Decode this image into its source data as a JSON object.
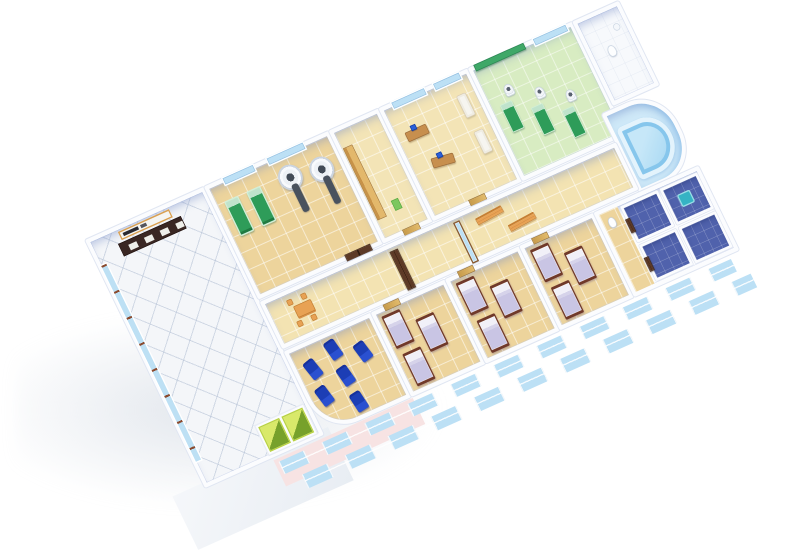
{
  "scene": {
    "description": "3D isometric cutaway floor plan of a hospital ward floor on a white background",
    "background_color": "#ffffff",
    "view": "axonometric cutaway, building rotated diagonally"
  },
  "palette": {
    "floor_tile_tan": "#EDD49C",
    "floor_lobby_white": "#F4F6F9",
    "floor_physio_green": "#D8ECC2",
    "floor_bath_blue": "#5062AC",
    "wall_white": "#FBFCFE",
    "wall_inner_tint": "#C8D5F0",
    "window_blue": "#BCE0F5",
    "facade_pink": "#F7E3E3",
    "bed_frame_brown": "#70392A",
    "bedding_lavender": "#C9C5E4",
    "exam_table_green": "#2E9C59",
    "recliner_blue": "#1C3EB5",
    "furniture_orange": "#E8A254",
    "door_dark_brown": "#5D3A26",
    "door_light_wood": "#D2A756",
    "elevator_green": "#B9D243",
    "pool_blue": "#AEDCF5"
  },
  "rooms": {
    "lobby": {
      "label": "Lobby and reception hall",
      "items": [
        "reception desk",
        "sign board with dark illegible lettering",
        "brown-framed window wall",
        "2 green elevators",
        "diamond tiled floor"
      ]
    },
    "radiology": {
      "label": "Radiology / scanner room",
      "items": [
        "2 green exam beds",
        "2 CT scanners with patient tables",
        "dark brown double door"
      ]
    },
    "storage": {
      "label": "Storage room",
      "items": [
        "wooden cabinet",
        "green mat"
      ]
    },
    "office": {
      "label": "Doctors office",
      "items": [
        "2 desks with blue computer monitors",
        "2 white couches"
      ]
    },
    "physio": {
      "label": "Physiotherapy room",
      "items": [
        "3 green treatment tables",
        "3 C-arm machines",
        "green wall panels"
      ]
    },
    "toilet": {
      "label": "Toilet room",
      "items": [
        "toilet",
        "sink"
      ]
    },
    "hydro": {
      "label": "Hydrotherapy corner with curved pool",
      "items": [
        "curved blue pool",
        "rounded glass corner wall"
      ]
    },
    "corridor": {
      "label": "Corridor",
      "items": [
        "orange table with 4 chairs",
        "2 wooden benches",
        "dark double door",
        "glass sliding door",
        "light wood doors"
      ]
    },
    "infusion": {
      "label": "Infusion / recliner room",
      "items": [
        "6 blue recliner chairs",
        "rounded corner wall"
      ]
    },
    "ward1": {
      "label": "Patient ward 1",
      "items": [
        "3 wooden beds with lavender bedding"
      ]
    },
    "ward2": {
      "label": "Patient ward 2",
      "items": [
        "3 wooden beds with lavender bedding"
      ]
    },
    "ward3": {
      "label": "Patient ward 3",
      "items": [
        "3 wooden beds with lavender bedding"
      ]
    },
    "bathrooms": {
      "label": "Bathroom block",
      "items": [
        "4 blue-tiled shower stalls",
        "teal shower tray",
        "toilet",
        "dark brown stall doors"
      ]
    }
  },
  "facade": {
    "window_rows": 2,
    "left_tint": "pink",
    "window_color": "#BCE0F5"
  }
}
